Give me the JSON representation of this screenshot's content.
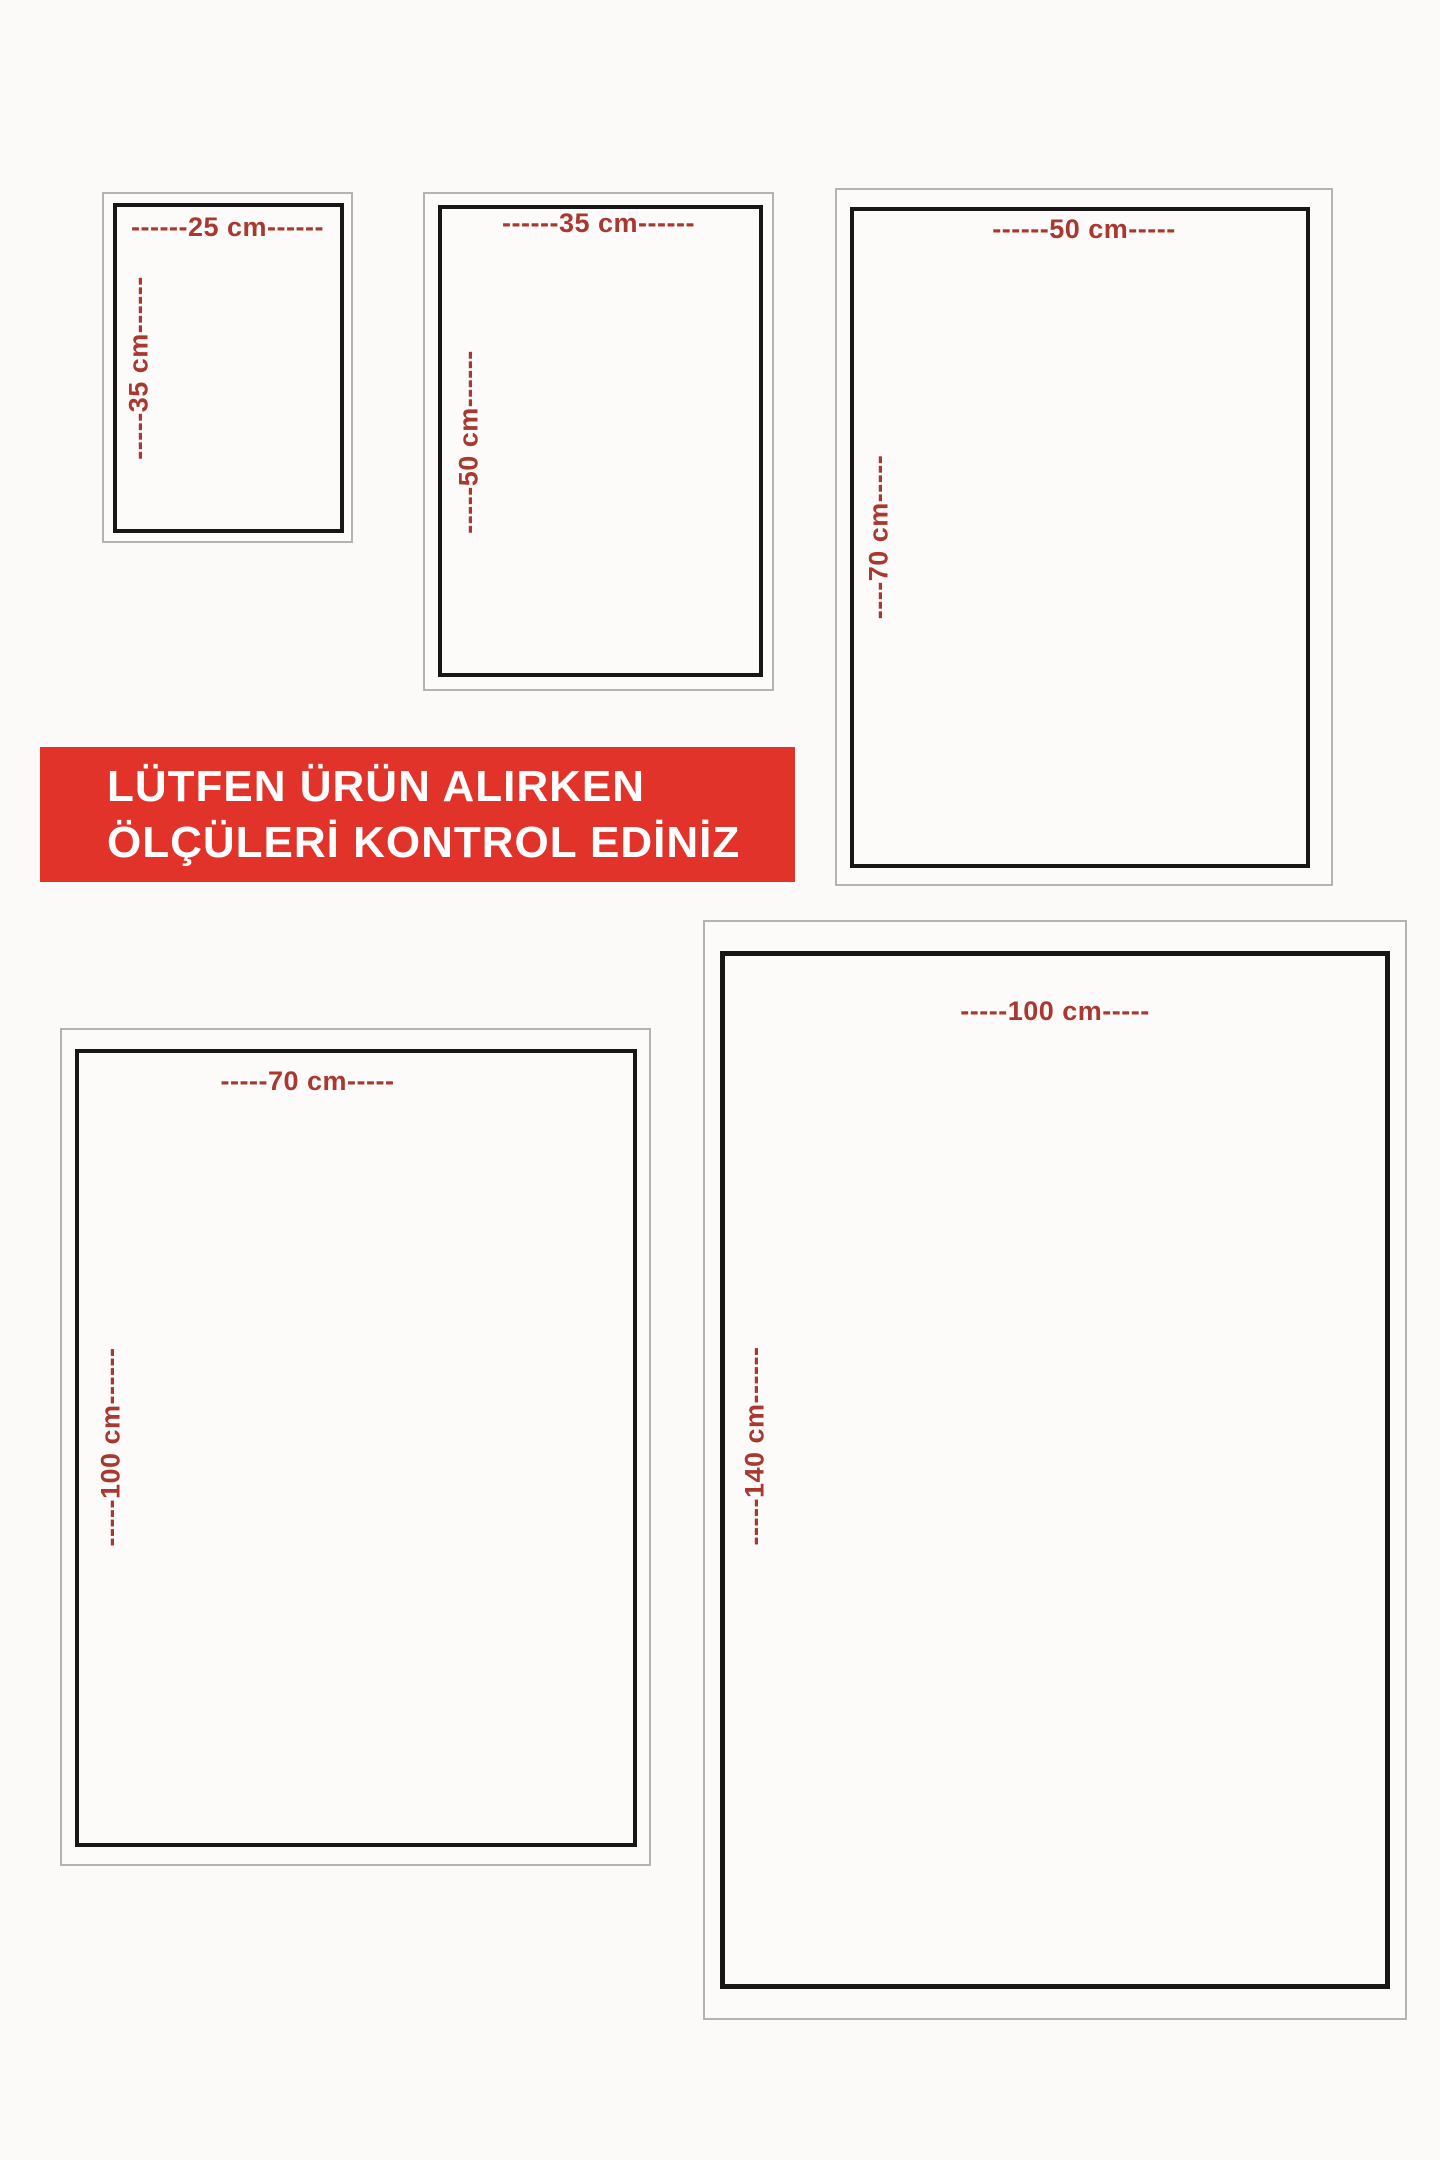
{
  "banner": {
    "line1": "LÜTFEN ÜRÜN ALIRKEN",
    "line2": "ÖLÇÜLERİ KONTROL EDİNİZ",
    "background": "#e1332a",
    "text_color": "#ffffff"
  },
  "style": {
    "label_color": "#a93831",
    "border_color": "#171717",
    "frame_color": "#b5b3b0",
    "page_background": "#fbfaf8"
  },
  "rects": [
    {
      "width_cm": 25,
      "height_cm": 35,
      "top_label": "------25 cm------",
      "side_label": "-----35 cm------"
    },
    {
      "width_cm": 35,
      "height_cm": 50,
      "top_label": "------35 cm------",
      "side_label": "-----50 cm------"
    },
    {
      "width_cm": 50,
      "height_cm": 70,
      "top_label": "------50 cm-----",
      "side_label": "----70 cm-----"
    },
    {
      "width_cm": 70,
      "height_cm": 100,
      "top_label": "-----70 cm-----",
      "side_label": "-----100 cm------"
    },
    {
      "width_cm": 100,
      "height_cm": 140,
      "top_label": "-----100 cm-----",
      "side_label": "-----140 cm------"
    }
  ]
}
